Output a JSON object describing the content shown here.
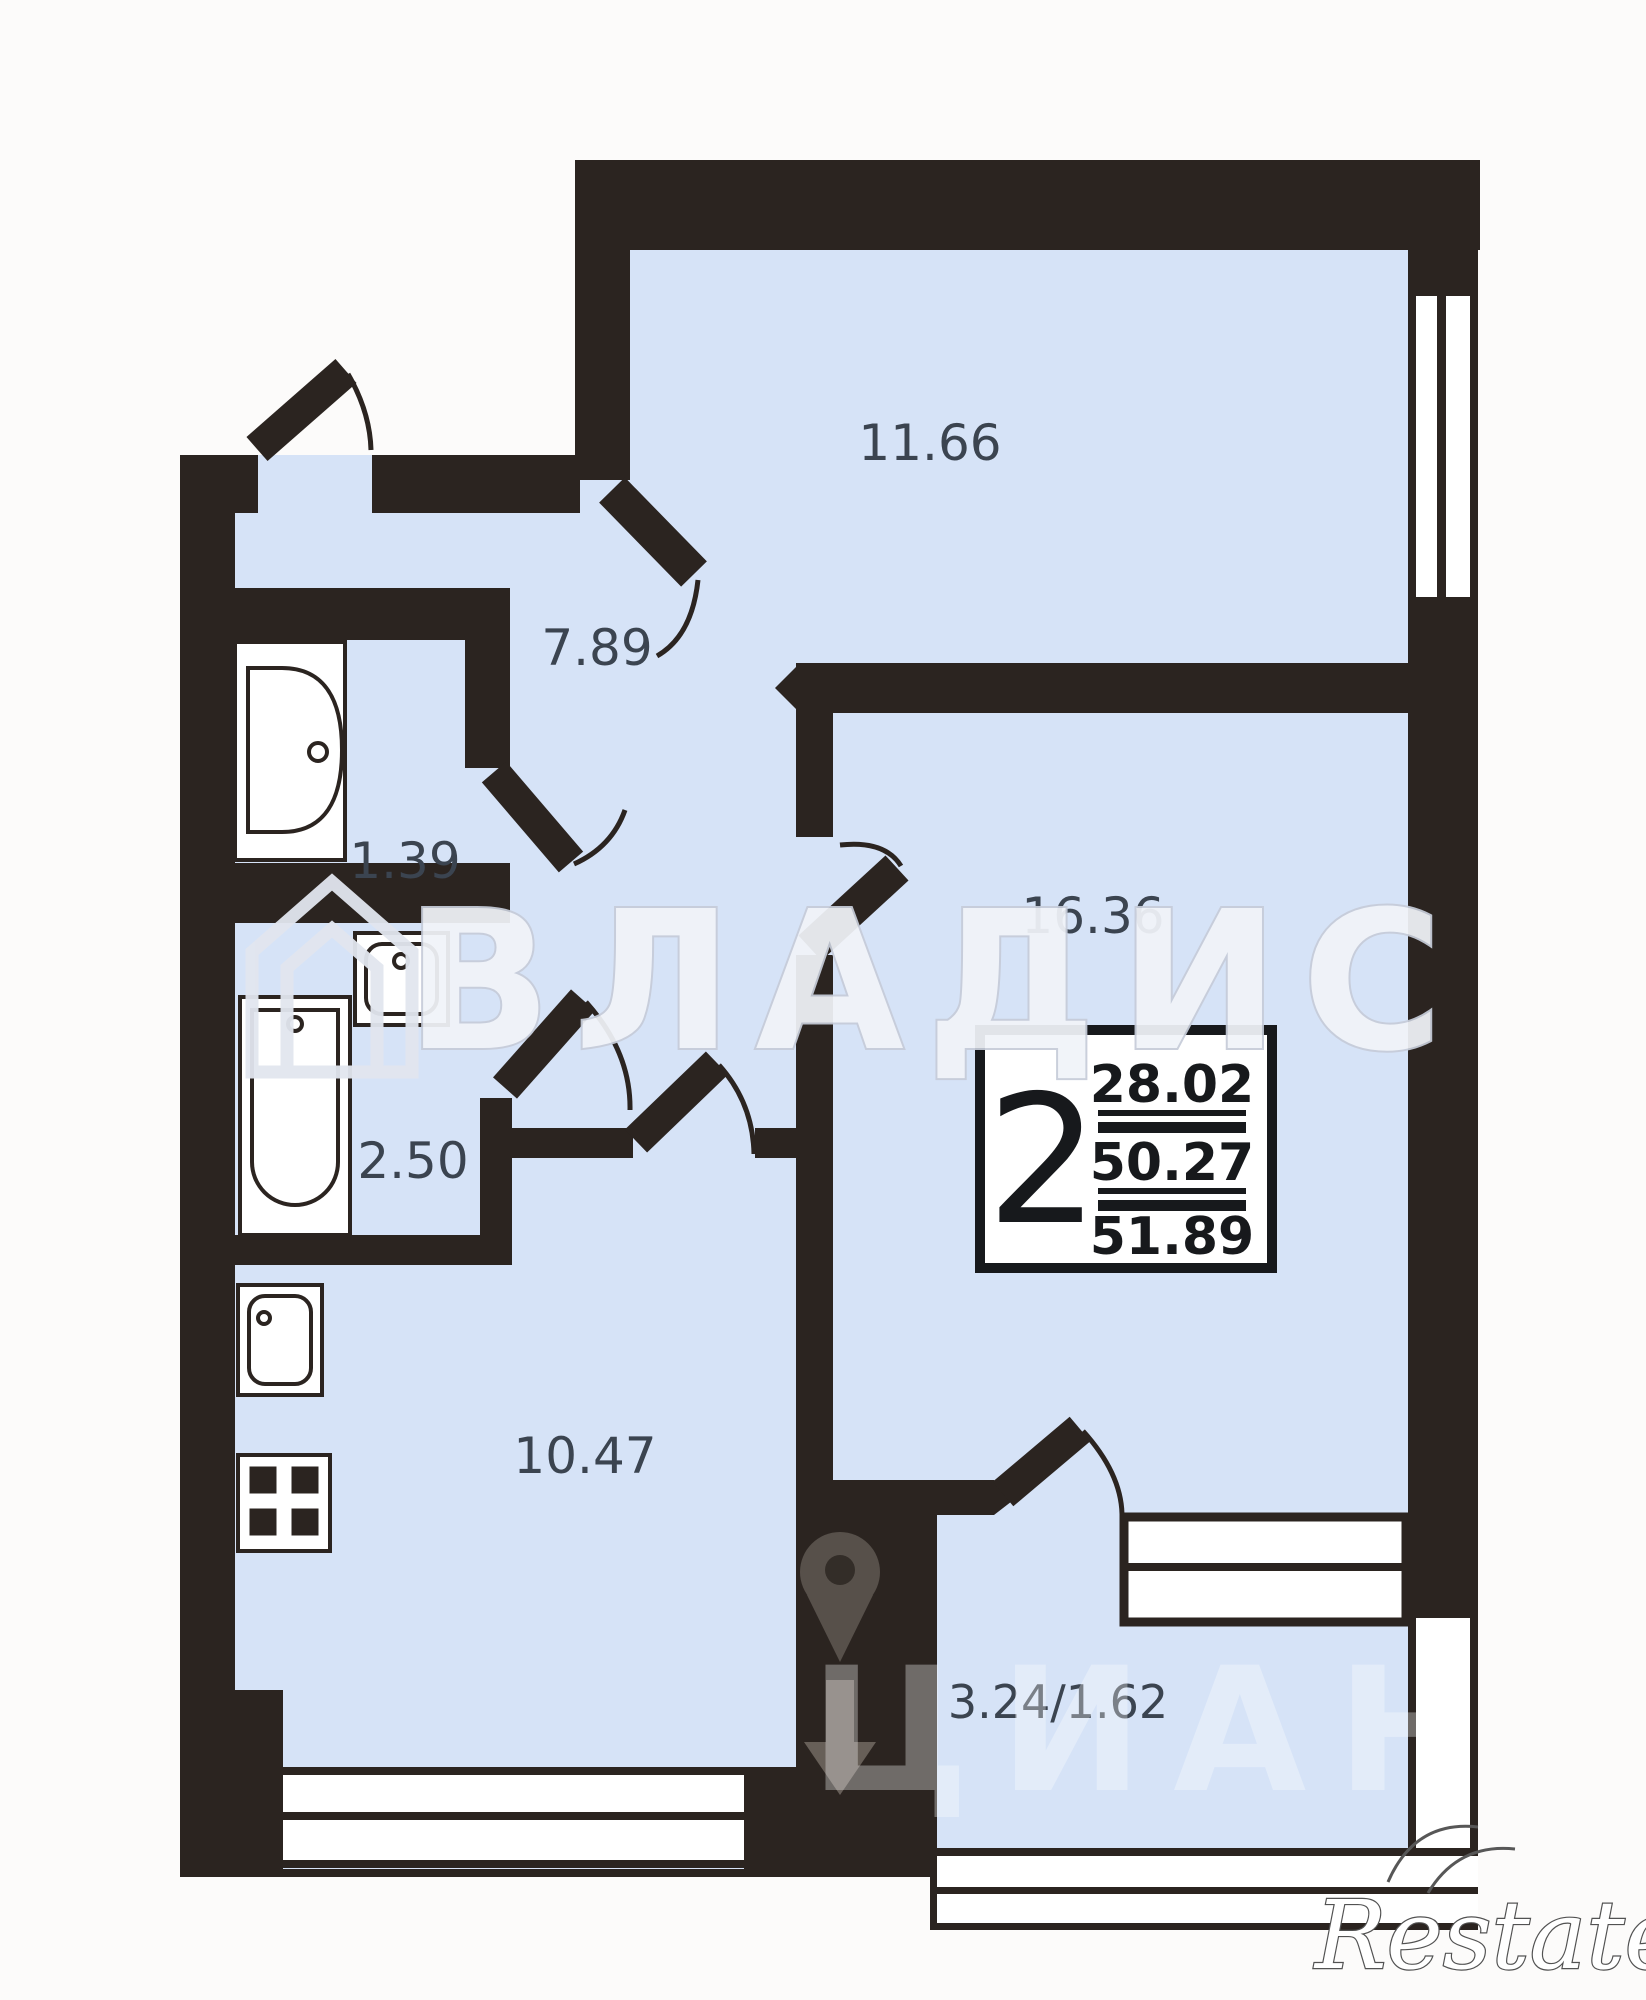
{
  "rooms": {
    "living": {
      "name": "room",
      "label": "11.66"
    },
    "hall": {
      "name": "hallway",
      "label": "7.89"
    },
    "wc": {
      "name": "wc",
      "label": "1.39"
    },
    "bath": {
      "name": "bathroom",
      "label": "2.50"
    },
    "bedroom": {
      "name": "room",
      "label": "16.36"
    },
    "kitchen": {
      "name": "kitchen",
      "label": "10.47"
    },
    "balcony": {
      "name": "balcony",
      "label": "3.24/1.62"
    }
  },
  "info_box": {
    "room_count": "2",
    "line1": "28.02",
    "line2": "50.27",
    "line3": "51.89"
  },
  "watermarks": {
    "agency": "ВЛАДИС",
    "portal": "ЦИАН",
    "footer": "Restate"
  },
  "colors": {
    "floor": "#d6e3f7",
    "wall": "#2b2420",
    "label": "#3b4450",
    "background": "#fcfbfa"
  }
}
